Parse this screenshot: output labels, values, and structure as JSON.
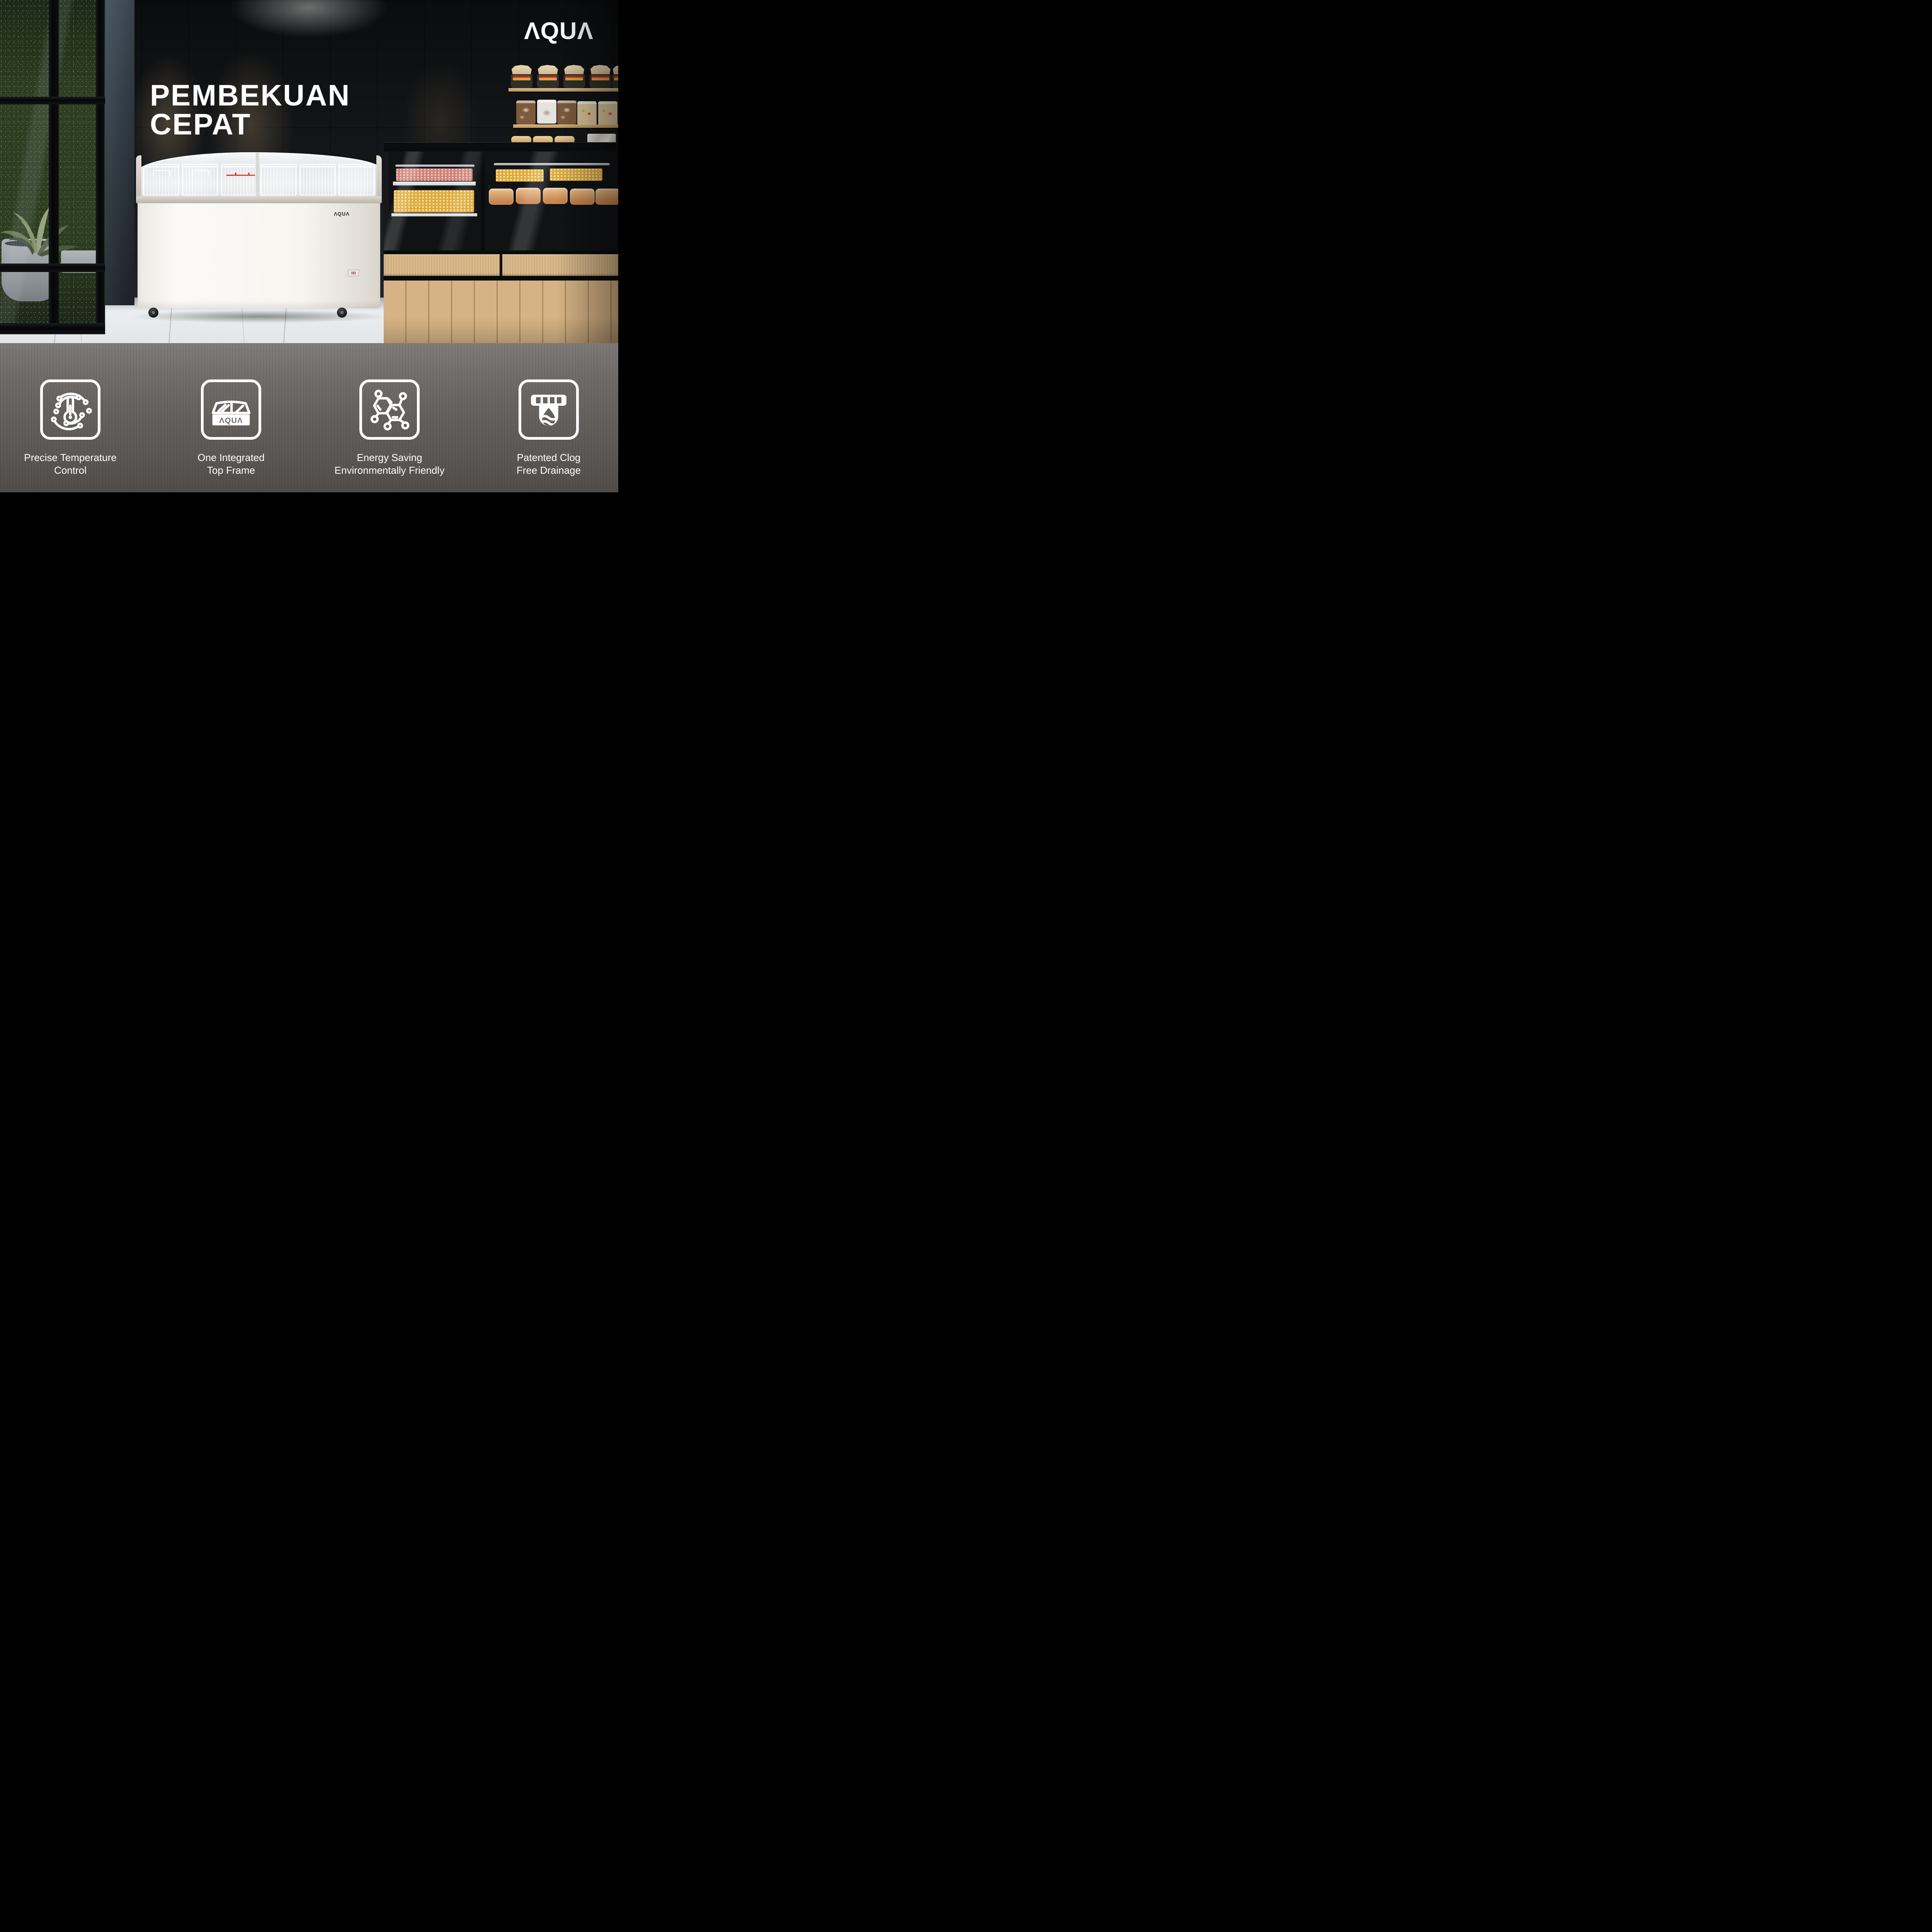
{
  "brand": {
    "name": "AQUA",
    "display_glyphs": "ΛQUΛ"
  },
  "hero": {
    "title_line1": "PEMBEKUAN",
    "title_line2": "CEPAT"
  },
  "freezer": {
    "front_logo_name": "AQUA",
    "front_logo_display": "ΛQUΛ"
  },
  "features": [
    {
      "icon": "precise-temperature-icon",
      "label_line1": "Precise Temperature",
      "label_line2": "Control"
    },
    {
      "icon": "integrated-top-frame-icon",
      "label_line1": "One Integrated",
      "label_line2": "Top Frame",
      "icon_logo_name": "AQUA",
      "icon_logo_display": "ΛQUΛ"
    },
    {
      "icon": "energy-saving-molecule-icon",
      "label_line1": "Energy Saving",
      "label_line2": "Environmentally Friendly"
    },
    {
      "icon": "clog-free-drainage-icon",
      "label_line1": "Patented Clog",
      "label_line2": "Free Drainage"
    }
  ],
  "colors": {
    "accent_red": "#cf2d26",
    "band_top": "#7b7774",
    "band_bottom": "#504d4a",
    "wood": "#d6b385",
    "plant_green": "#33441f",
    "text_white": "#ffffff"
  }
}
